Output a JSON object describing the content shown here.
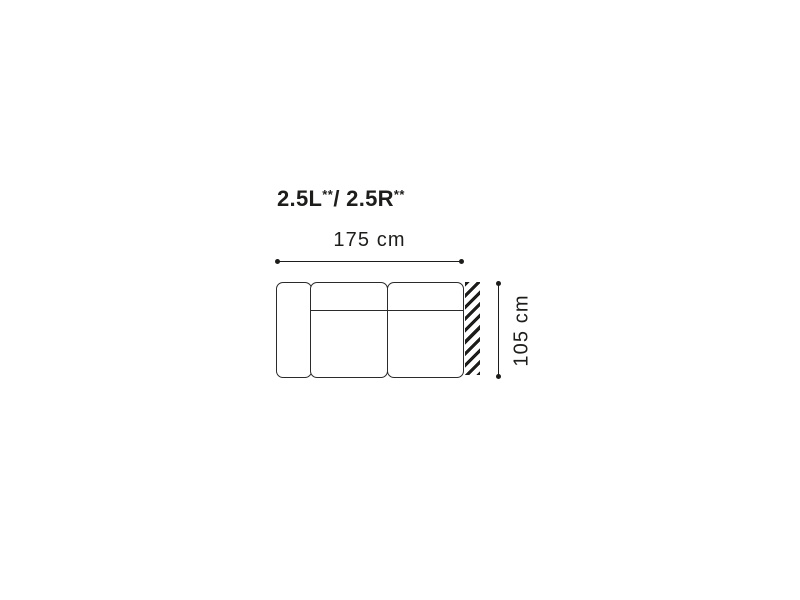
{
  "colors": {
    "background": "#ffffff",
    "ink": "#1d1d1b",
    "outline": "#2b2b2b"
  },
  "title": {
    "left_code": "2.5L",
    "left_mark": "**",
    "right_code": "/ 2.5R",
    "right_mark": "**"
  },
  "dimensions": {
    "width": {
      "label": "175 cm"
    },
    "depth": {
      "label": "105 cm"
    }
  },
  "figure": {
    "kind": "sofa-module-top-view",
    "modules": [
      "armrest-left",
      "seat-1",
      "seat-2"
    ],
    "hatched_edge": "right"
  }
}
